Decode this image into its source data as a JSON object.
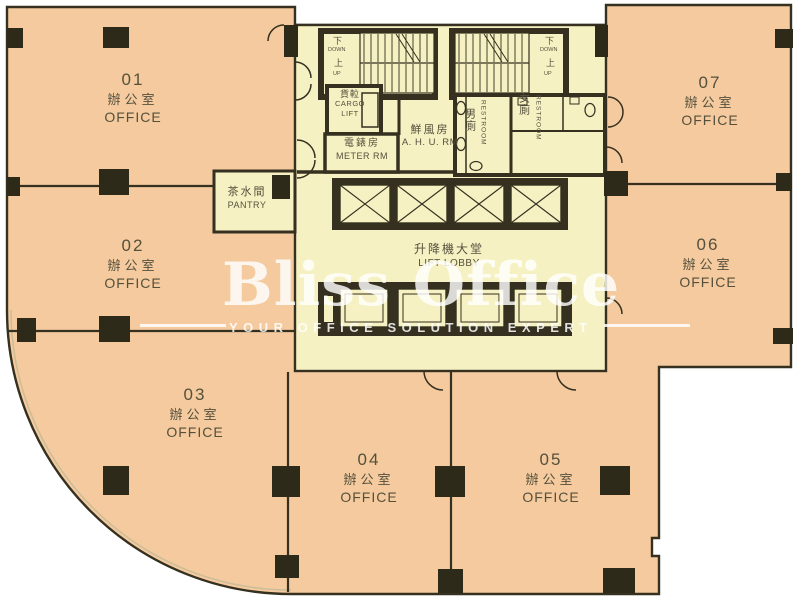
{
  "palette": {
    "office_fill": "#f4ca9e",
    "core_fill": "#f6f1c3",
    "wall": "#35301f",
    "label_text": "#55503c",
    "watermark": "#ffffff",
    "background": "#ffffff"
  },
  "watermark": {
    "brand": "Bliss Office",
    "tagline": "YOUR OFFICE SOLUTION EXPERT"
  },
  "offices": [
    {
      "num": "01",
      "zh": "辦公室",
      "en": "OFFICE"
    },
    {
      "num": "02",
      "zh": "辦公室",
      "en": "OFFICE"
    },
    {
      "num": "03",
      "zh": "辦公室",
      "en": "OFFICE"
    },
    {
      "num": "04",
      "zh": "辦公室",
      "en": "OFFICE"
    },
    {
      "num": "05",
      "zh": "辦公室",
      "en": "OFFICE"
    },
    {
      "num": "06",
      "zh": "辦公室",
      "en": "OFFICE"
    },
    {
      "num": "07",
      "zh": "辦公室",
      "en": "OFFICE"
    }
  ],
  "rooms": {
    "pantry": {
      "zh": "茶水間",
      "en": "PANTRY"
    },
    "meter": {
      "zh": "電錶房",
      "en": "METER RM"
    },
    "cargo_lift": {
      "zh": "貨𨋢",
      "en_line1": "CARGO",
      "en_line2": "LIFT"
    },
    "ahu": {
      "zh": "鮮風房",
      "en": "A. H. U. RM"
    },
    "lift_lobby": {
      "zh": "升降機大堂",
      "en": "LIFT LOBBY"
    },
    "male_toilet": {
      "zh": "男廁",
      "en": "RESTROOM"
    },
    "female_toilet": {
      "zh": "女廁",
      "en": "RESTROOM"
    },
    "stair": {
      "down_zh": "下",
      "down_en": "DOWN",
      "up_zh": "上",
      "up_en": "UP"
    }
  }
}
